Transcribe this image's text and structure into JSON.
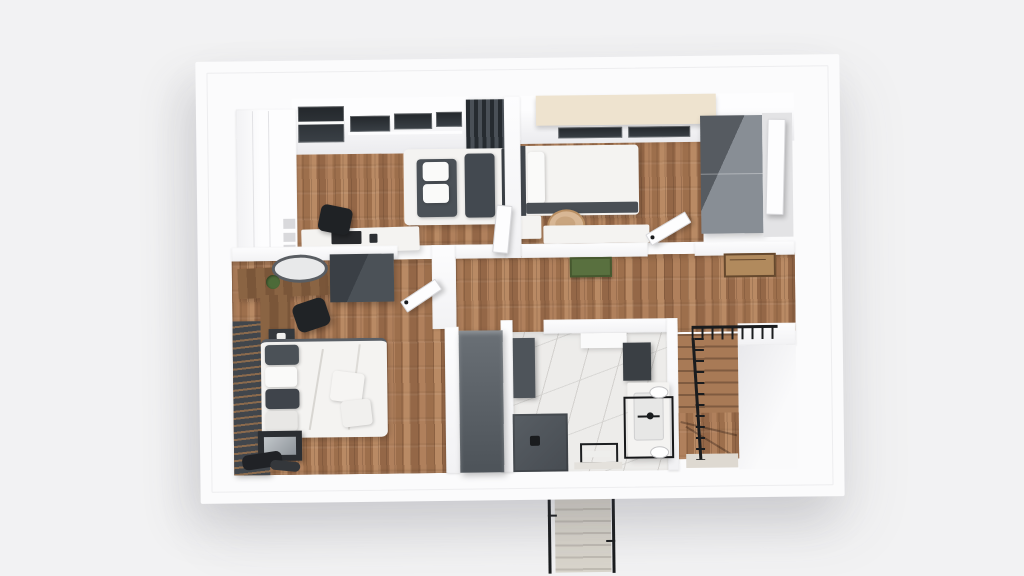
{
  "scene": {
    "type": "3d-rendered-floor-plan",
    "view": "top-down bird's eye",
    "background_color": "#f2f2f3",
    "rooms": [
      {
        "name": "bedroom-top-left",
        "floor": "wood",
        "furniture": [
          "white-wardrobe",
          "skylight",
          "windows",
          "single-bed",
          "curtain",
          "desk",
          "desk-chair",
          "monitor"
        ]
      },
      {
        "name": "bedroom-top-right",
        "floor": "wood",
        "furniture": [
          "cream-canopy",
          "window",
          "single-bed",
          "nightstand",
          "tan-chair",
          "desk",
          "gray-wardrobe",
          "white-door"
        ]
      },
      {
        "name": "master-bedroom",
        "floor": "wood",
        "furniture": [
          "slat-accent-wall",
          "vanity-desk",
          "round-mirror",
          "plant",
          "black-chair",
          "gray-dresser",
          "nightstand",
          "double-bed",
          "throw-pillows",
          "tv-unit",
          "clothes",
          "tall-wardrobe"
        ]
      },
      {
        "name": "bathroom",
        "floor": "marble",
        "furniture": [
          "tall-cabinet",
          "shelf",
          "dark-panel",
          "vanity-sink",
          "mirror-frame",
          "sconce-lights",
          "shower",
          "towel-rack",
          "bath-mat"
        ]
      },
      {
        "name": "hallway",
        "floor": "wood",
        "furniture": [
          "green-doormat",
          "jute-rug",
          "interior-stairs",
          "stair-railing"
        ]
      }
    ],
    "exterior": [
      "entry-stairs",
      "entry-stair-railings"
    ]
  },
  "palette": {
    "bg": "#f2f2f3",
    "band": "#fbfbfc",
    "wall": "#f7f7f8",
    "wood1": "#b0805c",
    "wood2": "#9d6f4c",
    "wood3": "#b98a64",
    "wood4": "#946747",
    "dark": "#4b5157",
    "dark2": "#3a3f45",
    "black": "#1a1c1e",
    "whitef": "#f4f3f1",
    "marble": "#edecea",
    "vein": "#d3d1ce",
    "cream": "#eee3cf",
    "tan": "#d8b795",
    "green": "#59703f",
    "jute": "#b18a5d",
    "concrete": "#d9d5cc",
    "slatgap": "#8a6a4d",
    "glass": "#2e3338"
  }
}
